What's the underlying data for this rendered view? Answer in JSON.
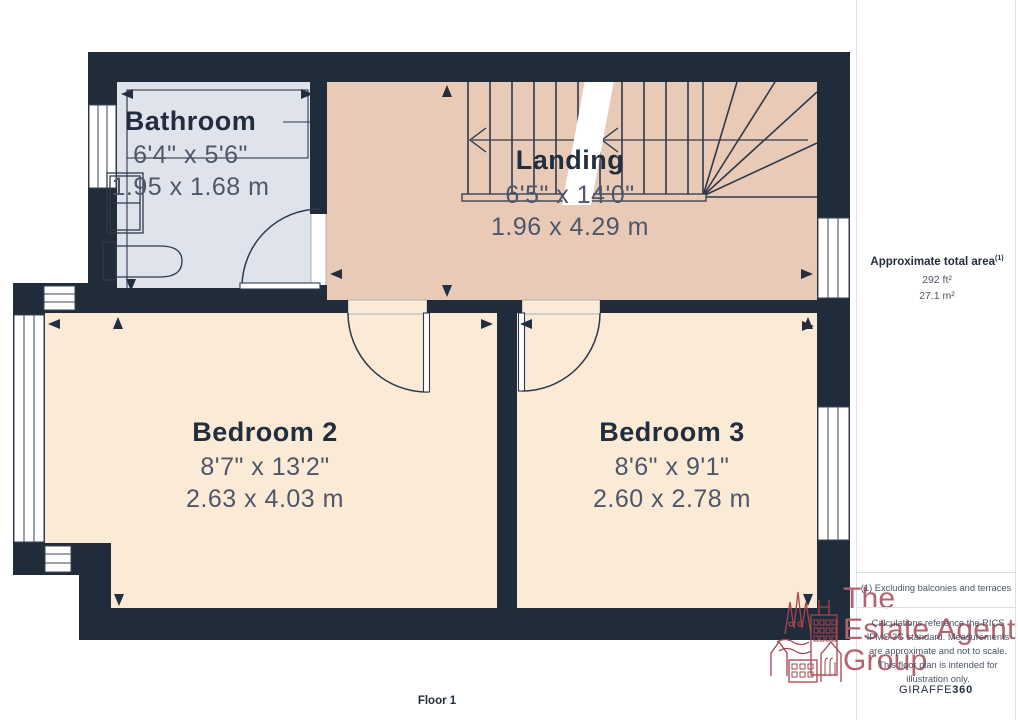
{
  "page": {
    "floor_label": "Floor 1"
  },
  "rooms": {
    "bathroom": {
      "name": "Bathroom",
      "imperial": "6'4\" x 5'6\"",
      "metric": "1.95 x 1.68 m"
    },
    "landing": {
      "name": "Landing",
      "imperial": "6'5\" x 14'0\"",
      "metric": "1.96 x 4.29 m"
    },
    "bedroom2": {
      "name": "Bedroom 2",
      "imperial": "8'7\" x 13'2\"",
      "metric": "2.63 x 4.03 m"
    },
    "bedroom3": {
      "name": "Bedroom 3",
      "imperial": "8'6\" x 9'1\"",
      "metric": "2.60 x 2.78 m"
    }
  },
  "sidebar": {
    "area_title": "Approximate total area",
    "area_note_ref": "(1)",
    "area_imperial": "292 ft²",
    "area_metric": "27.1 m²",
    "footnote": "(1) Excluding balconies and terraces",
    "disclaimer": "Calculations reference the RICS IPMS 3C standard. Measurements are approximate and not to scale. This floor plan is intended for illustration only.",
    "brand_name": "GIRAFFE",
    "brand_suffix": "360"
  },
  "logo": {
    "line1": "The",
    "line2": "Estate Agent",
    "line3": "Group"
  },
  "colors": {
    "wall": "#212c3a",
    "bathroom_floor": "#dfe3ec",
    "landing_floor": "#e9cab7",
    "bedroom_floor": "#fbead6",
    "plan_line": "#2e3a4c",
    "room_label": "#222e3e",
    "dimension_text": "#4e5769",
    "logo_text": "#b36370",
    "logo_art": "#a4454f",
    "divider": "#dcdfe4"
  }
}
